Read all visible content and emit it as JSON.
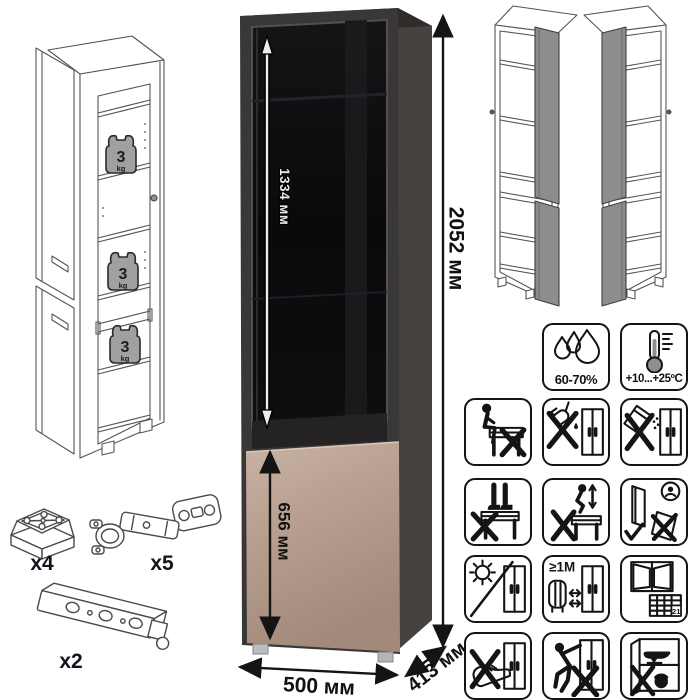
{
  "dimensions": {
    "overall_height": "2052 мм",
    "glass_door_height": "1334 мм",
    "lower_door_height": "656 мм",
    "width": "500 мм",
    "depth": "413 мм"
  },
  "shelf_load": {
    "value": "3",
    "unit": "kg"
  },
  "hardware": [
    {
      "part": "adjustable-foot",
      "qty": "x4"
    },
    {
      "part": "cup-hinge",
      "qty": "x5"
    },
    {
      "part": "mounting-rail",
      "qty": "x2"
    }
  ],
  "climate": {
    "humidity": "60-70%",
    "temperature": "+10...+25ºC"
  },
  "warnings": {
    "heat_distance": "≥1M",
    "calendar_day": "21",
    "pictograms": [
      "humidity-icon",
      "temperature-icon",
      "no-sitting-icon",
      "no-pouring-liquids-icon",
      "no-spilling-powder-icon",
      "no-standing-icon",
      "no-jumping-icon",
      "carry-door-correctly-icon",
      "no-direct-sunlight-icon",
      "keep-1m-from-heater-icon",
      "ventilate-room-icon",
      "no-pushing-with-shoe-icon",
      "no-dragging-icon",
      "no-heavy-items-icon"
    ]
  },
  "colors": {
    "frame": "#3a3737",
    "side": "#474240",
    "glass": "#0d0d0f",
    "lower_door": "#b3a091",
    "wireframe_door": "#8d8d8d",
    "weight": "#a0a0a0"
  }
}
